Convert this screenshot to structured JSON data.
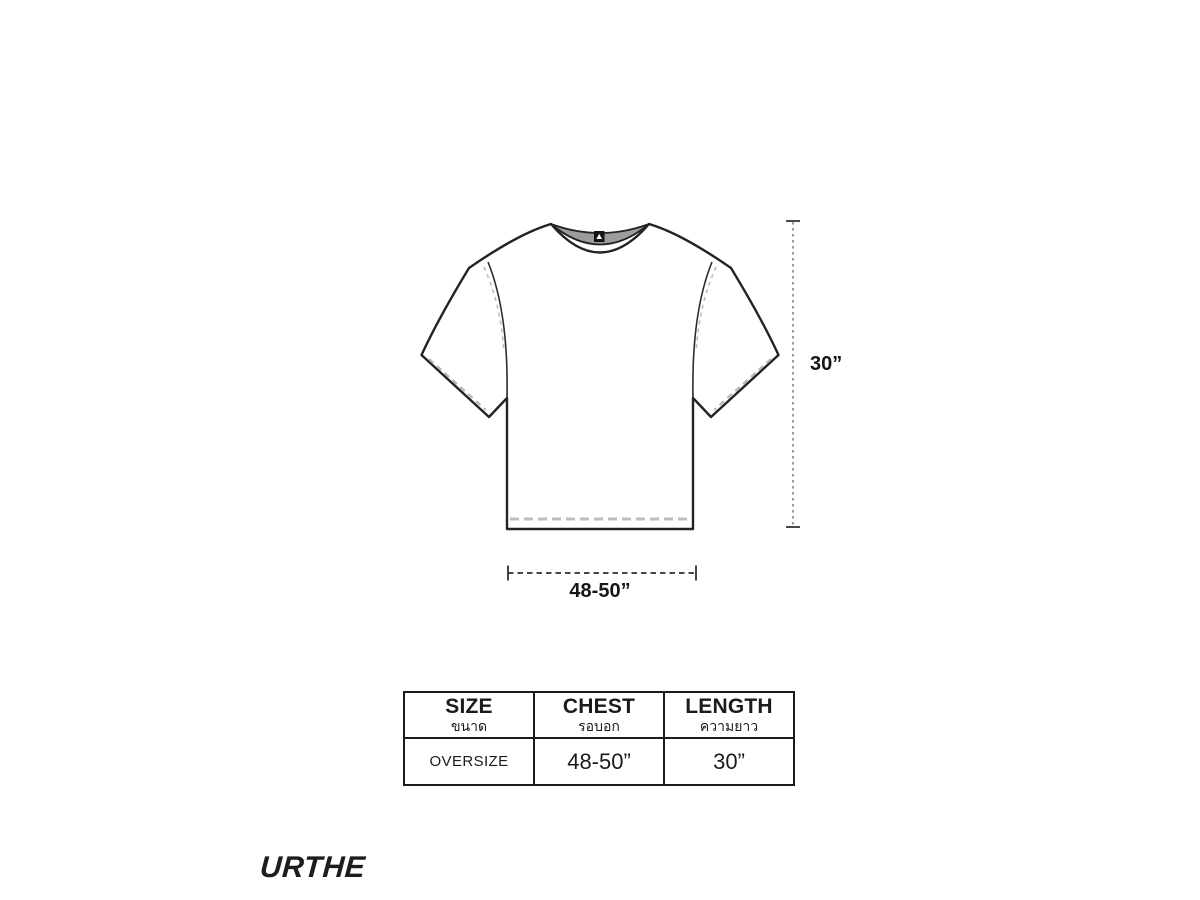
{
  "diagram": {
    "length_dimension_label": "30”",
    "chest_dimension_label": "48-50”"
  },
  "size_table": {
    "headers": [
      {
        "en": "SIZE",
        "th": "ขนาด"
      },
      {
        "en": "CHEST",
        "th": "รอบอก"
      },
      {
        "en": "LENGTH",
        "th": "ความยาว"
      }
    ],
    "rows": [
      {
        "size": "OVERSIZE",
        "chest": "48-50”",
        "length": "30”"
      }
    ]
  },
  "brand": {
    "logo": "URTHE"
  },
  "colors": {
    "outline": "#232323",
    "dash_gray": "#b9b9b9",
    "collar_inside_gray": "#9c9c9c",
    "dimension_dot_gray": "#9b9b9b",
    "text": "#1b1b1b",
    "background": "#ffffff"
  }
}
